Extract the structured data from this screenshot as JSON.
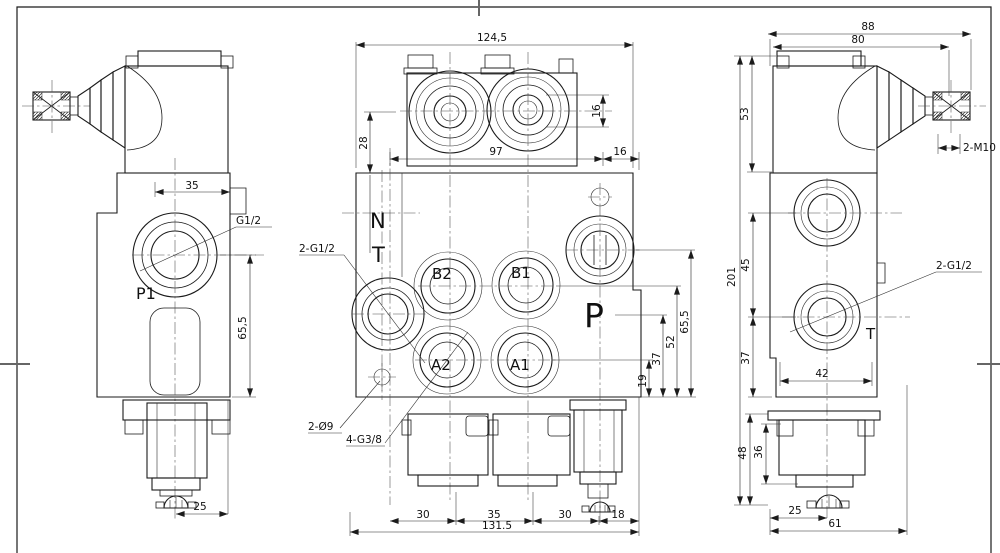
{
  "drawing": {
    "left_view": {
      "label_p1": "P1",
      "label_g12": "G1/2",
      "dim_35": "35",
      "dim_65_5": "65,5",
      "dim_25": "25"
    },
    "front_view": {
      "label_n": "N",
      "label_t": "T",
      "label_p": "P",
      "label_b2": "B2",
      "label_b1": "B1",
      "label_a2": "A2",
      "label_a1": "A1",
      "label_2g12": "2-G1/2",
      "label_2d9": "2-Ø9",
      "label_4g38": "4-G3/8",
      "dim_124_5": "124,5",
      "dim_28": "28",
      "dim_16_bore": "16",
      "dim_97": "97",
      "dim_16_edge": "16",
      "dim_19": "19",
      "dim_37": "37",
      "dim_52": "52",
      "dim_65_5": "65,5",
      "dim_30_a": "30",
      "dim_35": "35",
      "dim_30_b": "30",
      "dim_18": "18",
      "dim_131_5": "131.5"
    },
    "right_view": {
      "label_2m10": "2-M10",
      "label_2g12": "2-G1/2",
      "label_t": "T",
      "dim_88": "88",
      "dim_80": "80",
      "dim_53": "53",
      "dim_201": "201",
      "dim_45": "45",
      "dim_37": "37",
      "dim_42": "42",
      "dim_48": "48",
      "dim_36": "36",
      "dim_25": "25",
      "dim_61": "61"
    }
  }
}
